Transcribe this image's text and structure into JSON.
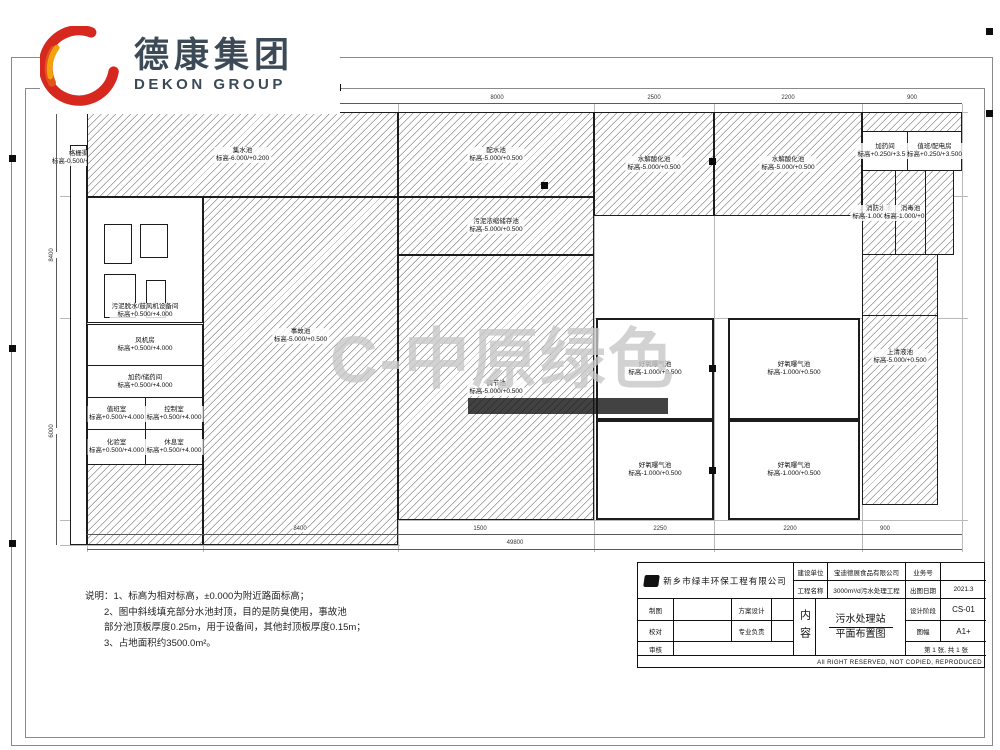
{
  "logo": {
    "cn": "德康集团",
    "en": "DEKON GROUP"
  },
  "watermark": {
    "mark": "C",
    "text": "-中原绿色"
  },
  "tanks": [
    {
      "name": "格栅渠",
      "elev": "标高-0.500/+0.500"
    },
    {
      "name": "集水池",
      "elev": "标高-6.000/+0.200"
    },
    {
      "name": "配水池",
      "elev": "标高-5.000/+0.500"
    },
    {
      "name": "水解酸化池",
      "elev": "标高-5.000/+0.500"
    },
    {
      "name": "水解酸化池",
      "elev": "标高-5.000/+0.500"
    },
    {
      "name": "污泥脱水/鼓风机设备间",
      "elev": "标高+0.500/+4.000"
    },
    {
      "name": "事故池",
      "elev": "标高-5.000/+0.500"
    },
    {
      "name": "污泥浓缩储存池",
      "elev": "标高-5.000/+0.500"
    },
    {
      "name": "调节池",
      "elev": "标高-5.000/+0.500"
    },
    {
      "name": "好氧曝气池",
      "elev": "标高-1.000/+0.500"
    },
    {
      "name": "好氧曝气池",
      "elev": "标高-1.000/+0.500"
    },
    {
      "name": "好氧曝气池",
      "elev": "标高-1.000/+0.500"
    },
    {
      "name": "好氧曝气池",
      "elev": "标高-1.000/+0.500"
    },
    {
      "name": "上清液池",
      "elev": "标高-5.000/+0.500"
    },
    {
      "name": "加药间",
      "elev": "标高+0.250/+3.500"
    },
    {
      "name": "值班/配电房",
      "elev": "标高+0.250/+3.500"
    },
    {
      "name": "消防水池",
      "elev": "标高-1.000/+0.500"
    },
    {
      "name": "消毒池",
      "elev": "标高-1.000/+0.500"
    },
    {
      "name": "风机房",
      "elev": "标高+0.500/+4.000"
    },
    {
      "name": "加药/储药间",
      "elev": "标高+0.500/+4.000"
    },
    {
      "name": "值班室",
      "elev": "标高+0.500/+4.000"
    },
    {
      "name": "控制室",
      "elev": "标高+0.500/+4.000"
    },
    {
      "name": "化验室",
      "elev": "标高+0.500/+4.000"
    },
    {
      "name": "休息室",
      "elev": "标高+0.500/+4.000"
    }
  ],
  "dims": {
    "top": [
      "3600",
      "8400",
      "8000",
      "2500",
      "2200",
      "900"
    ],
    "bottom": [
      "8400",
      "1500",
      "2250",
      "2200",
      "900"
    ],
    "total": "49800",
    "left": [
      "8400",
      "6000"
    ]
  },
  "notes": {
    "l1": "说明：1、标高为相对标高，±0.000为附近路面标高；",
    "l2": "2、图中斜线填充部分水池封顶，目的是防臭使用，事故池",
    "l3": "部分池顶板厚度0.25m，用于设备间，其他封顶板厚度0.15m；",
    "l4": "3、占地面积约3500.0m²。"
  },
  "titleblock": {
    "design_company": "新乡市绿丰环保工程有限公司",
    "label_owner": "建设单位",
    "owner": "宝迪德展食品有限公司",
    "label_project": "工程名称",
    "project": "3000m³/d污水处理工程",
    "label_jobno": "业务号",
    "jobno": "",
    "label_date": "出图日期",
    "date": "2021.3",
    "label_stage": "设计阶段",
    "stage": "CS-01",
    "label_size": "图幅",
    "size": "A1+",
    "label_draft": "制图",
    "label_scheme": "方案设计",
    "label_check": "校对",
    "label_lead": "专业负责",
    "label_review": "审核",
    "label_content": "内容",
    "content_line1": "污水处理站",
    "content_line2": "平面布置图",
    "sheet": "第 1 张, 共 1 张",
    "copyright": "All RIGHT RESERVED, NOT COPIED, REPRODUCED"
  }
}
